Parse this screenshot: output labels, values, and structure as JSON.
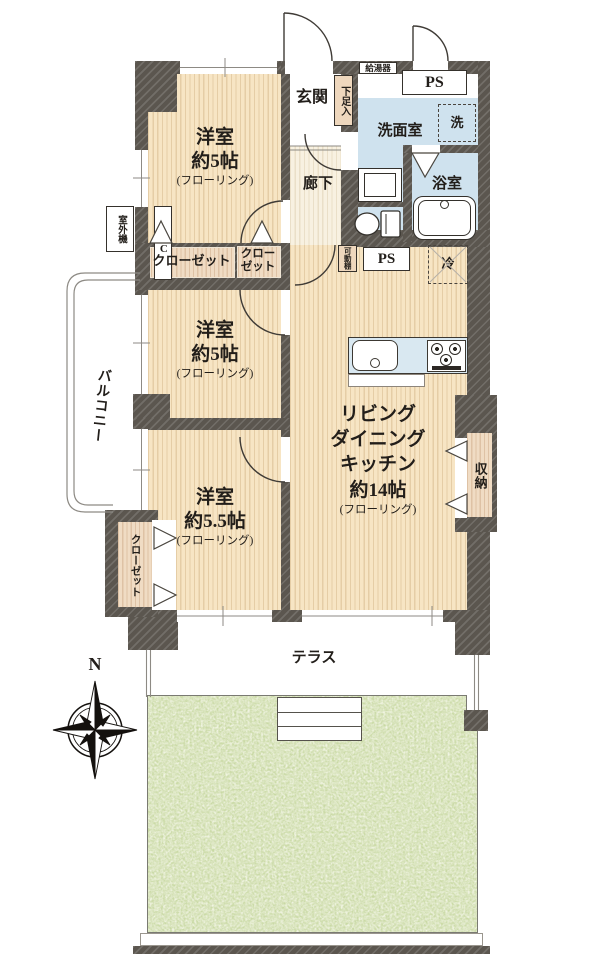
{
  "title": "floor-plan",
  "colors": {
    "wall": "#5b564f",
    "room_floor": "#f7e5c4",
    "wet_area": "#cfe2ee",
    "hall_floor": "#f8f1e1",
    "closet_floor": "#f0dcc4",
    "garden_green": "#c9d9a4"
  },
  "labels": {
    "bedroom1": {
      "name": "洋室",
      "size": "約5帖",
      "floor": "(フローリング)"
    },
    "bedroom2": {
      "name": "洋室",
      "size": "約5帖",
      "floor": "(フローリング)"
    },
    "bedroom3": {
      "name": "洋室",
      "size": "約5.5帖",
      "floor": "(フローリング)"
    },
    "ldk": {
      "l1": "リビング",
      "l2": "ダイニング",
      "l3": "キッチン",
      "l4": "約14帖",
      "l5": "(フローリング)"
    },
    "entrance": "玄関",
    "hall": "廊下",
    "shoe_box": "下足入",
    "water_heater": "給湯器",
    "ps_top": "PS",
    "ps_mid": "PS",
    "washroom": "洗面室",
    "washer": "洗",
    "bathroom": "浴室",
    "movable_shelf": "可動棚",
    "fridge": "冷",
    "closet_a": "クローゼット",
    "closet_b_line1": "クロー",
    "closet_b_line2": "ゼット",
    "closet_c": "クローゼット",
    "storage": "収納",
    "ac": "AC",
    "outdoor_unit": "室外機",
    "balcony": "バルコニー",
    "terrace": "テラス",
    "garden": "専用庭",
    "north": "N"
  }
}
